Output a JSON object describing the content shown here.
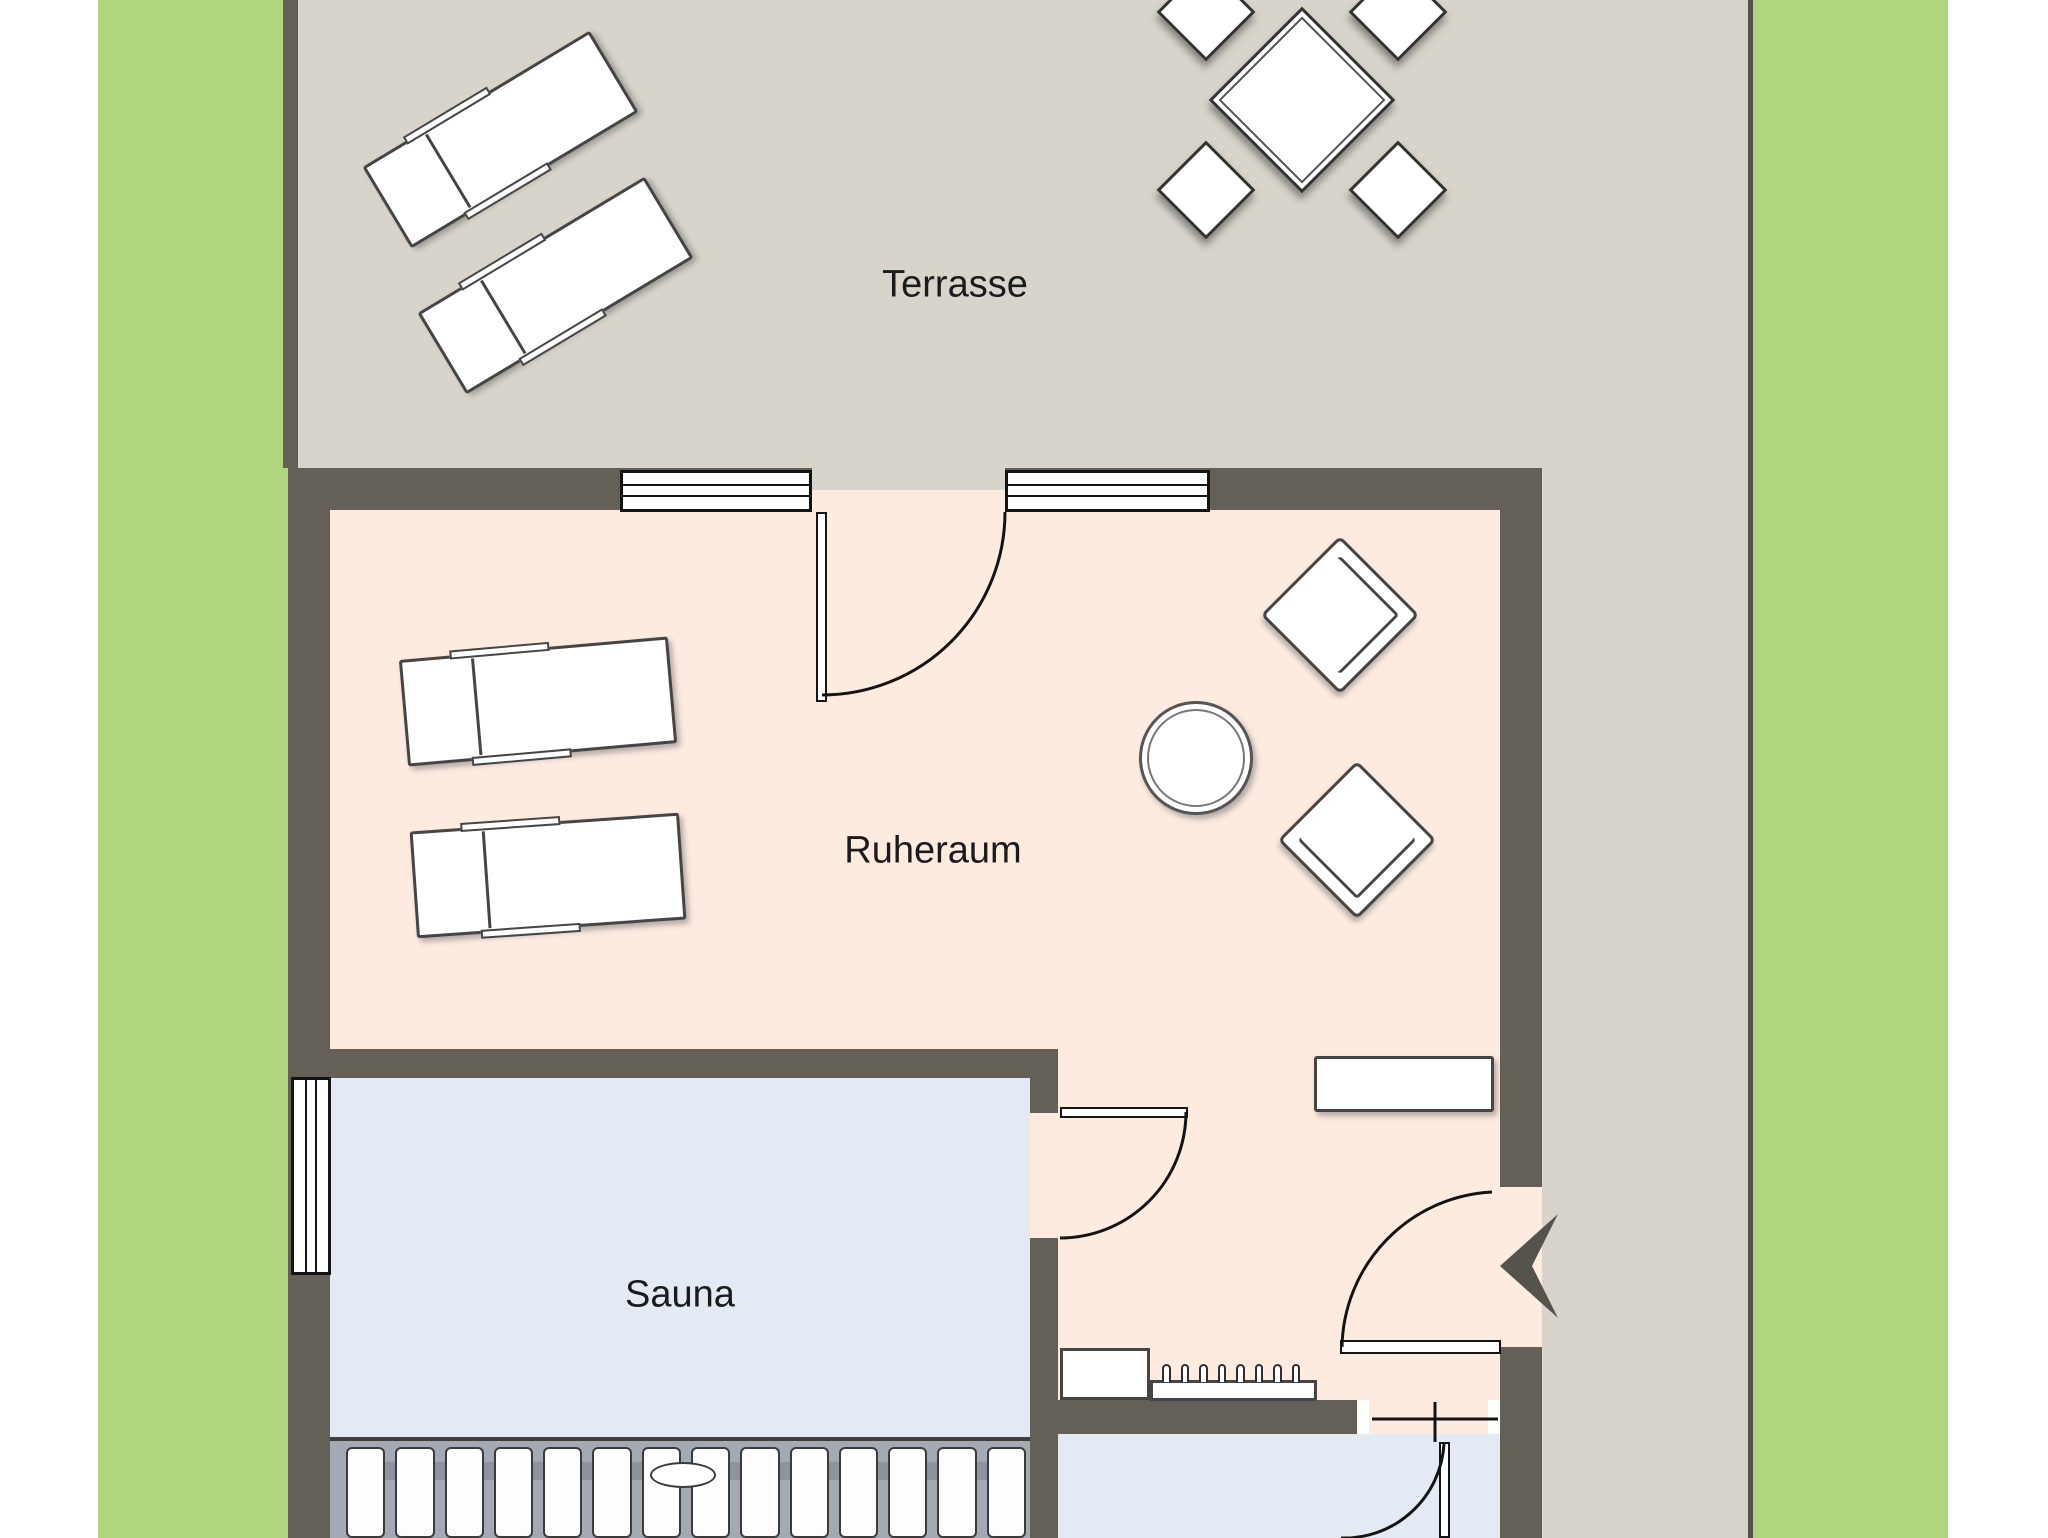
{
  "rooms": {
    "terrace": {
      "label": "Terrasse"
    },
    "relax_room": {
      "label": "Ruheraum"
    },
    "sauna": {
      "label": "Sauna"
    }
  },
  "furniture": {
    "terrace_loungers": 2,
    "dining_chairs": 4,
    "relax_loungers": 2,
    "armchairs": 2,
    "side_tables": 1,
    "sideboards": 1,
    "coat_hooks": 8,
    "bench_slats": 14
  },
  "colors": {
    "garden_green": "#afd67f",
    "paving_gray": "#d8d4cb",
    "wall": "#646058",
    "relax_floor": "#fdebe0",
    "sauna_floor": "#e4eaf3",
    "bench_gray": "#a4aab3",
    "door_line": "#141414",
    "arrow": "#56534c"
  }
}
